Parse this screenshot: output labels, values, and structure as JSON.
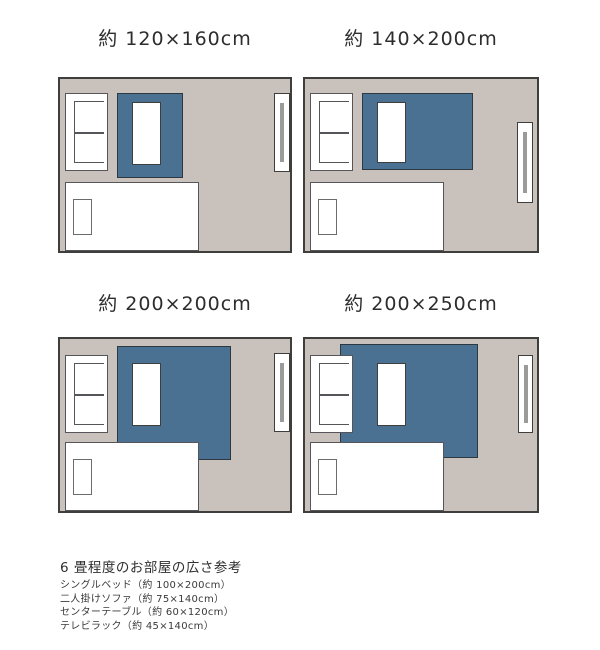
{
  "page": {
    "description": "Rug size comparison in a 6-tatami room, top view",
    "background": "#ffffff"
  },
  "colors": {
    "room_fill": "#c8c1bc",
    "room_border": "#3e3e3c",
    "rug_fill": "#4a7092",
    "rug_border": "#2e3840",
    "furniture_fill": "#ffffff",
    "furniture_border": "#55555a",
    "pillow_border": "#6b6b6b",
    "tv_rack_bar": "#9b9b99",
    "title_text": "#2d2d2d",
    "note_text": "#3a3a3a"
  },
  "diagrams": [
    {
      "id": "rug-120x160",
      "title": "約 120×160cm",
      "furniture": [
        "two-seat-sofa",
        "rug",
        "center-table",
        "tv-rack",
        "single-bed",
        "pillow"
      ]
    },
    {
      "id": "rug-140x200",
      "title": "約 140×200cm",
      "furniture": [
        "two-seat-sofa",
        "rug",
        "center-table",
        "tv-rack",
        "single-bed",
        "pillow"
      ]
    },
    {
      "id": "rug-200x200",
      "title": "約 200×200cm",
      "furniture": [
        "two-seat-sofa",
        "rug",
        "center-table",
        "tv-rack",
        "single-bed",
        "pillow"
      ]
    },
    {
      "id": "rug-200x250",
      "title": "約 200×250cm",
      "furniture": [
        "two-seat-sofa",
        "rug",
        "center-table",
        "tv-rack",
        "single-bed",
        "pillow"
      ]
    }
  ],
  "legend": {
    "heading": "6 畳程度のお部屋の広さ参考",
    "items": [
      "シングルベッド（約 100×200cm）",
      "二人掛けソファ（約 75×140cm）",
      "センターテーブル（約 60×120cm）",
      "テレビラック（約 45×140cm）"
    ]
  }
}
